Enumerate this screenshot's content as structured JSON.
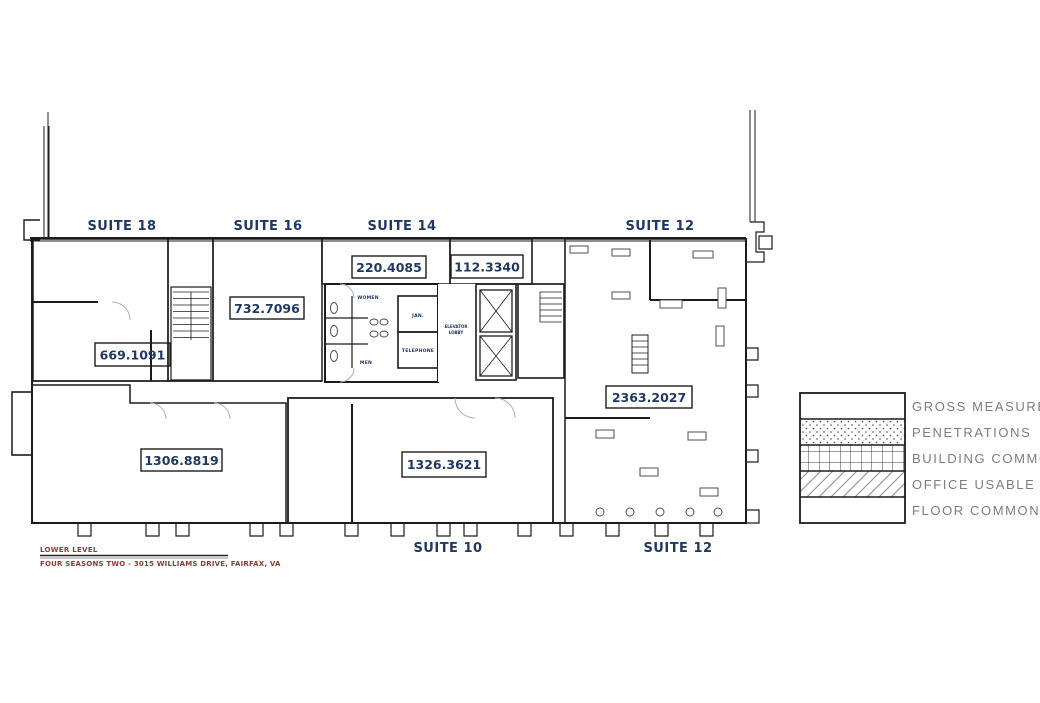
{
  "title_block": {
    "level": "LOWER LEVEL",
    "building": "FOUR SEASONS TWO - 3015 WILLIAMS DRIVE, FAIRFAX, VA"
  },
  "suites": {
    "top": [
      {
        "label": "SUITE 18"
      },
      {
        "label": "SUITE 16"
      },
      {
        "label": "SUITE 14"
      },
      {
        "label": "SUITE 12"
      }
    ],
    "bottom": [
      {
        "label": "SUITE 10"
      },
      {
        "label": "SUITE 12"
      }
    ]
  },
  "areas": [
    {
      "id": "suite-18",
      "value": "669.1091"
    },
    {
      "id": "suite-16",
      "value": "732.7096"
    },
    {
      "id": "suite-14",
      "value": "220.4085"
    },
    {
      "id": "core-penetration",
      "value": "112.3340"
    },
    {
      "id": "suite-12",
      "value": "2363.2027"
    },
    {
      "id": "building-common",
      "value": "1306.8819"
    },
    {
      "id": "suite-10",
      "value": "1326.3621"
    }
  ],
  "rooms": {
    "women": "WOMEN",
    "men": "MEN",
    "janitor": "JAN.",
    "telephone": "TELEPHONE",
    "elevator_lobby_line1": "ELEVATOR",
    "elevator_lobby_line2": "LOBBY"
  },
  "legend": {
    "items": [
      {
        "label": "GROSS MEASURED",
        "swatch": "blank"
      },
      {
        "label": "PENETRATIONS",
        "swatch": "dots"
      },
      {
        "label": "BUILDING COMMON",
        "swatch": "grid"
      },
      {
        "label": "OFFICE USABLE",
        "swatch": "diagonal"
      },
      {
        "label": "FLOOR COMMON",
        "swatch": "blank"
      }
    ]
  },
  "colors": {
    "label_navy": "#1f3864",
    "title_red": "#8a3c30",
    "legend_text": "#7d7d7d",
    "wall": "#1c1c1c"
  }
}
